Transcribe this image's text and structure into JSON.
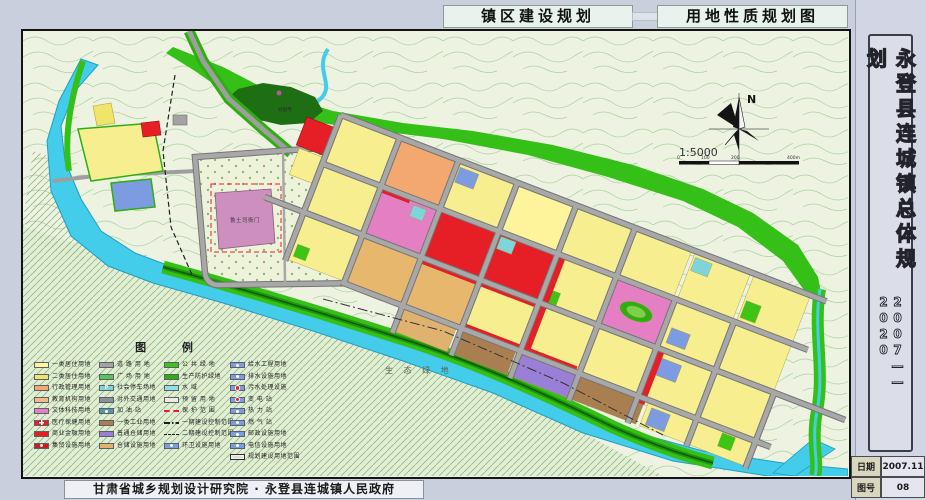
{
  "titles": {
    "left": "镇区建设规划",
    "right": "用地性质规划图"
  },
  "sidebar": {
    "title_vertical": "永登县连城镇总体规划",
    "years": "2007——2020",
    "date_label": "日期",
    "date_value": "2007.11",
    "sheet_label": "图号",
    "sheet_value": "08"
  },
  "footer": {
    "credit": "甘肃省城乡规划设计研究院 · 永登县连城镇人民政府"
  },
  "map": {
    "compass_label": "N",
    "scale_text": "1:5000",
    "scale_ticks": [
      "0",
      "100",
      "200",
      "400m"
    ],
    "labels": {
      "historic_site": "鲁土司衙门",
      "eco_green": "生 态 绿 地",
      "temple": "妙因寺"
    }
  },
  "legend": {
    "title": "图 例",
    "columns": [
      [
        {
          "label": "一类居住用地",
          "color": "#fdf49c"
        },
        {
          "label": "二类居住用地",
          "color": "#f1e46b"
        },
        {
          "label": "行政管理用地",
          "color": "#f2a86e"
        },
        {
          "label": "教育机构用地",
          "color": "#f4b98a"
        },
        {
          "label": "文体科技用地",
          "color": "#e47fc4"
        },
        {
          "label": "医疗保健用地",
          "color": "#e61e25",
          "symbol": "cross"
        },
        {
          "label": "商业金融用地",
          "color": "#e61e25"
        },
        {
          "label": "集贸设施用地",
          "color": "#d3181f",
          "symbol": "dot-white"
        }
      ],
      [
        {
          "label": "道 路 用 地",
          "color": "#a3a3a3"
        },
        {
          "label": "广 场 用 地",
          "color": "#56c556"
        },
        {
          "label": "社会停车场地",
          "color": "#7fd4dc",
          "symbol": "p"
        },
        {
          "label": "对外交通用地",
          "color": "#8f9097"
        },
        {
          "label": "加 油 站",
          "color": "#4f9aa8",
          "symbol": "dot-white"
        },
        {
          "label": "一类工业用地",
          "color": "#a97f52"
        },
        {
          "label": "普通仓储用地",
          "color": "#9a7fd6"
        },
        {
          "label": "仓储设施用地",
          "color": "#dfb26f"
        }
      ],
      [
        {
          "label": "公 共 绿 地",
          "color": "#3ec414"
        },
        {
          "label": "生产防护绿地",
          "color": "#2fae12"
        },
        {
          "label": "水    域",
          "color": "#8fe0ec"
        },
        {
          "label": "预 留 用 地",
          "color": "#eceedd"
        },
        {
          "label": "保 护 范 围",
          "type": "line-red-dash"
        },
        {
          "label": "一期建设控制范围",
          "type": "line-dashdot"
        },
        {
          "label": "二期建设控制范围",
          "type": "line-dash"
        },
        {
          "label": "环卫设施用地",
          "color": "#7c9be0",
          "symbol": "dot-white"
        }
      ],
      [
        {
          "label": "给水工程用地",
          "color": "#7c9be0",
          "symbol": "dot-white"
        },
        {
          "label": "排水设施用地",
          "color": "#7c9be0",
          "symbol": "dot-white"
        },
        {
          "label": "污水处理设施",
          "color": "#7c9be0",
          "symbol": "dot-red"
        },
        {
          "label": "变 电 站",
          "color": "#7c9be0",
          "symbol": "dot-red"
        },
        {
          "label": "热 力 站",
          "color": "#7c9be0",
          "symbol": "dot-white"
        },
        {
          "label": "燃 气 站",
          "color": "#7c9be0",
          "symbol": "dot-white"
        },
        {
          "label": "邮政设施用地",
          "color": "#7c9be0",
          "symbol": "dot-white"
        },
        {
          "label": "电信设施用地",
          "color": "#7c9be0",
          "symbol": "dot-white"
        },
        {
          "label": "规划建设用地范围",
          "type": "boundary"
        }
      ]
    ]
  },
  "colors": {
    "page_bg": "#c9cfdd",
    "terrain": "#edf2e1",
    "contour": "#abd0a0",
    "river": "#43cdea",
    "public_green": "#3ec414",
    "protect_green": "#2fae12",
    "residential_yellow": "#f7ef8f",
    "commercial_red": "#e61e25",
    "culture_pink": "#e47fc4",
    "historic_mauve": "#cc8fbe",
    "industry_brown": "#a97f52",
    "storage_purple": "#9a7fd6",
    "utility_blue": "#7c9be0",
    "road_gray": "#9e9e9e"
  }
}
